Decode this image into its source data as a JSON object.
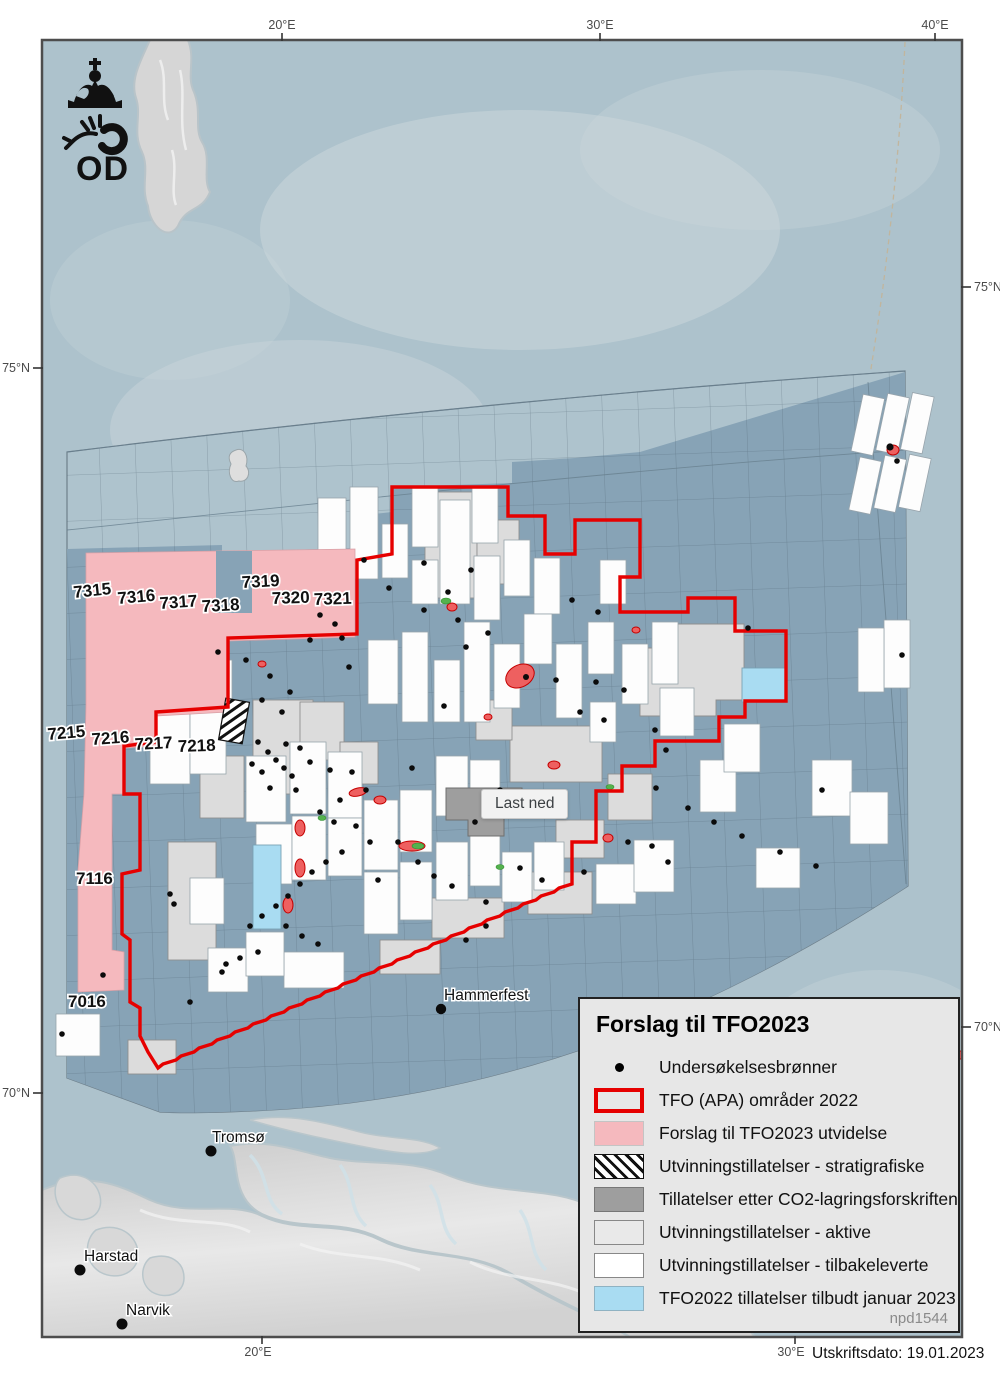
{
  "page": {
    "print_date": "Utskriftsdato: 19.01.2023"
  },
  "logo": {
    "org_abbrev": "OD"
  },
  "axis": {
    "top": [
      "20°E",
      "30°E",
      "40°E"
    ],
    "bottom": [
      "20°E",
      "30°E"
    ],
    "left": [
      "75°N",
      "70°N"
    ],
    "right": [
      "75°N",
      "70°N"
    ]
  },
  "map": {
    "quadrant_labels": {
      "r73": [
        "7315",
        "7316",
        "7317",
        "7318",
        "7319",
        "7320",
        "7321"
      ],
      "r72": [
        "7215",
        "7216",
        "7217",
        "7218"
      ],
      "r71": [
        "7116"
      ],
      "r70": [
        "7016"
      ]
    },
    "cities": [
      "Hammerfest",
      "Tromsø",
      "Harstad",
      "Narvik"
    ],
    "tooltip": {
      "label": "Last ned"
    }
  },
  "legend": {
    "title": "Forslag til TFO2023",
    "items": [
      {
        "label": "Undersøkelsesbrønner",
        "swatch": "well-dot"
      },
      {
        "label": "TFO (APA) områder 2022",
        "swatch": "red-outline"
      },
      {
        "label": "Forslag til TFO2023 utvidelse",
        "swatch": "pink-fill"
      },
      {
        "label": "Utvinningstillatelser - stratigrafiske",
        "swatch": "diagonal-hatch"
      },
      {
        "label": "Tillatelser etter CO2-lagringsforskriften",
        "swatch": "dark-gray-fill"
      },
      {
        "label": "Utvinningstillatelser - aktive",
        "swatch": "light-gray-fill"
      },
      {
        "label": "Utvinningstillatelser - tilbakeleverte",
        "swatch": "white-fill"
      },
      {
        "label": "TFO2022 tillatelser tilbudt januar 2023",
        "swatch": "light-blue-fill"
      }
    ],
    "map_id": "npd1544"
  },
  "colors": {
    "tfo_boundary_red": "#e60000",
    "proposal_pink": "#f5b9be",
    "tfo2022_blue": "#a9dcf2",
    "co2_gray": "#9e9e9e",
    "active_gray": "#dcdcdc",
    "returned_white": "#ffffff",
    "open_sea": "#adc2cc",
    "charted_sea": "#87a3b6"
  }
}
